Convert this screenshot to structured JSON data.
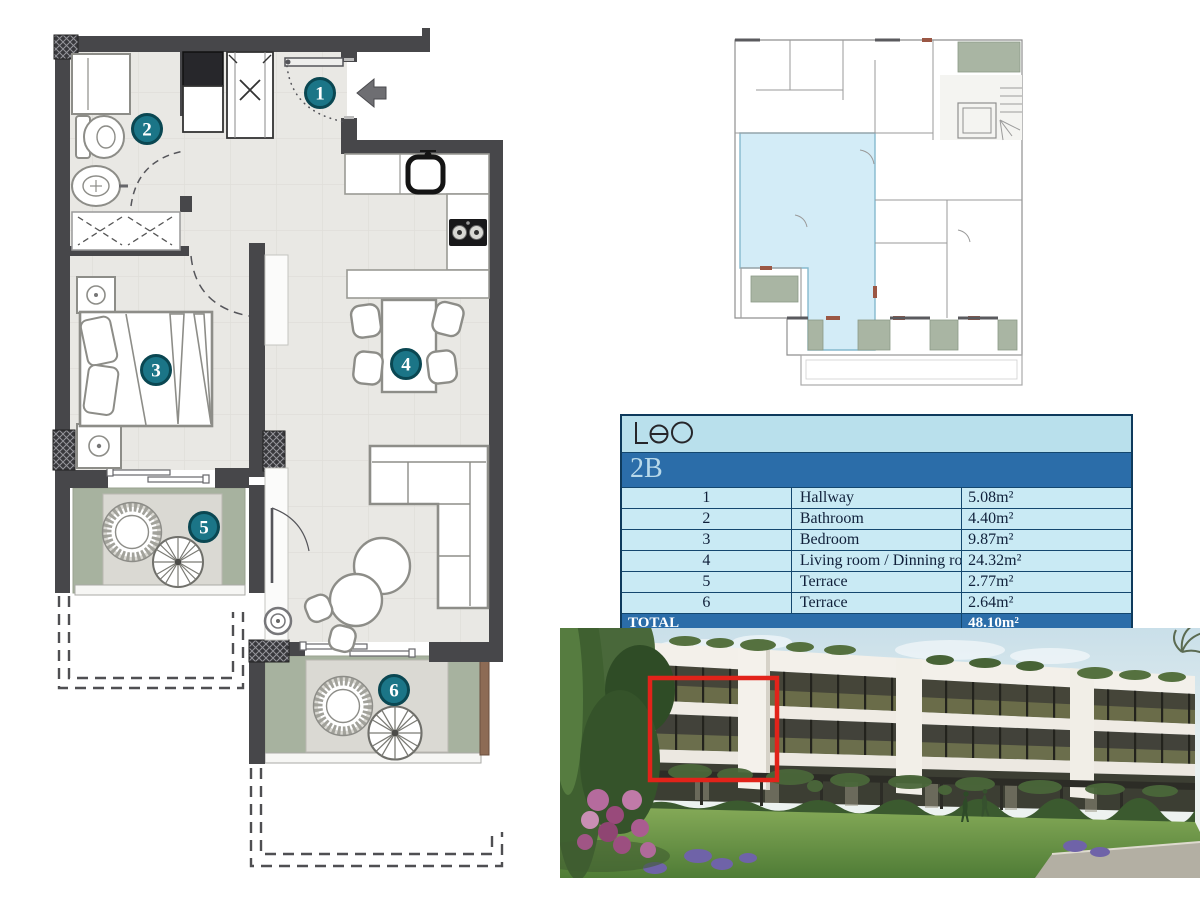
{
  "brand": {
    "logo_text": "Leo"
  },
  "unit": {
    "name": "2B",
    "rooms": [
      {
        "num": "1",
        "name": "Hallway",
        "area": "5.08m²"
      },
      {
        "num": "2",
        "name": "Bathroom",
        "area": "4.40m²"
      },
      {
        "num": "3",
        "name": "Bedroom",
        "area": "9.87m²"
      },
      {
        "num": "4",
        "name": "Living room / Dinning room / Kitchen",
        "area": "24.32m²"
      },
      {
        "num": "5",
        "name": "Terrace",
        "area": "2.77m²"
      },
      {
        "num": "6",
        "name": "Terrace",
        "area": "2.64m²"
      }
    ],
    "total_label": "TOTAL",
    "total_area": "48.10m²"
  },
  "colors": {
    "table_header_light_blue": "#b9e0ec",
    "table_row_blue": "#c9eaf4",
    "table_accent_blue": "#2b6da9",
    "table_border_navy": "#0e3a5c",
    "badge_teal": "#1b7587",
    "plan_wall_gray": "#47474a",
    "plan_floor_gray": "#e9e8e4",
    "terrace_green": "#a7b29f",
    "locator_unit_blue": "#d3ecf7",
    "photo_highlight_red": "#e2231a"
  }
}
